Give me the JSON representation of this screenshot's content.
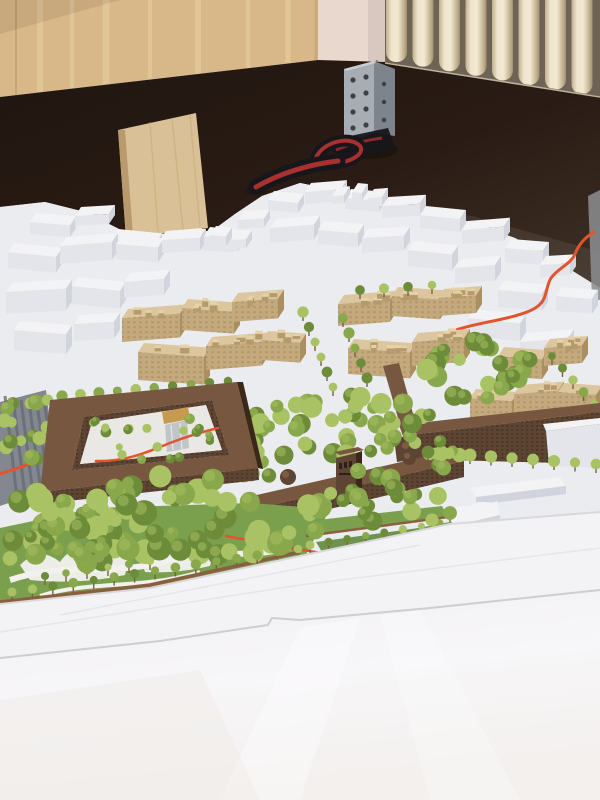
{
  "scene": {
    "type": "photograph",
    "description": "Photograph of a large architectural scale model of a city district, viewed from above. White context buildings surround a development site with dark brown brick buildings (a courtyard block, a long building with a central tower and domed pavilions, and an L-shaped perimeter block), light wood massing blocks for proposed buildings, many green model trees, a park with lawns and white paths, an orange route line, and a glossy white river plane in the foreground. Behind the model: a light wood cabinet, a pink plaster wall, a cream cast-iron radiator, a dark brown backdrop panel with a metal corner bracket, a leaning plywood board and a black strap with a red stripe."
  },
  "objects": [
    {
      "name": "wood-cabinet",
      "description": "light birch wood cabinet panel, top left"
    },
    {
      "name": "plaster-wall",
      "description": "pink plaster wall strip behind the model"
    },
    {
      "name": "radiator",
      "description": "cream cast-iron column radiator, top right"
    },
    {
      "name": "backdrop-panel",
      "description": "dark brown backdrop panel around the model"
    },
    {
      "name": "corner-bracket",
      "description": "perforated metal angle bracket at panel corner"
    },
    {
      "name": "plywood-board",
      "description": "plywood board leaning against the panel"
    },
    {
      "name": "fabric-strap",
      "description": "black strap with red stripe lying on the model"
    },
    {
      "name": "context-model",
      "description": "white massing model of surrounding city blocks"
    },
    {
      "name": "route-line",
      "description": "orange route line winding through the model"
    },
    {
      "name": "wood-massing-blocks",
      "description": "light wood blocks of proposed development with rooftop volumes"
    },
    {
      "name": "courtyard-building",
      "description": "dark brown courtyard block with gold-roofed hall and glass pavilion inside"
    },
    {
      "name": "tower-building",
      "description": "long brown building with central tower and two domed pavilions"
    },
    {
      "name": "perimeter-building",
      "description": "L-shaped brown perimeter building with street trees"
    },
    {
      "name": "model-trees",
      "description": "green foam model trees in park and along streets"
    },
    {
      "name": "park-lawn",
      "description": "green lawns with curving white paths and wooden edge walls"
    },
    {
      "name": "embankment",
      "description": "white embankment promenade"
    },
    {
      "name": "river-surface",
      "description": "glossy white river plane in the foreground"
    },
    {
      "name": "railway-strip",
      "description": "grey striped road/rail strip at left edge"
    }
  ],
  "colors": {
    "wood_cabinet": "#d8b888",
    "wood_cabinet_light": "#e9d3a7",
    "wood_cabinet_shadow": "#bd9c6f",
    "wall_plaster": "#e9d8ce",
    "radiator_gap": "#6e6354",
    "radiator_cream": "#efe4cc",
    "radiator_shadow": "#b3a489",
    "panel_edge_light": "#cfc3ac",
    "bracket_metal": "#a8adb3",
    "bracket_metal_dark": "#7e848b",
    "bracket_hole": "#3c4147",
    "plywood": "#d9c096",
    "plywood_edge": "#b89a6e",
    "strap_black": "#17161a",
    "strap_red": "#a8302e",
    "model_white": "#f3f3f6",
    "model_face_mid": "#e4e5ea",
    "model_face_shadow": "#d2d4dd",
    "model_base": "#ebecf0",
    "model_edge_gray": "#8d8e92",
    "railway_gray": "#83878f",
    "railway_stripe": "#656a73",
    "route_red": "#e2542f",
    "wood_block_top": "#dcc69e",
    "wood_block_side": "#c3a97c",
    "wood_block_shadow": "#ab8f60",
    "brick_brown": "#5e4433",
    "brick_brown_light": "#77573f",
    "brick_brown_dark": "#3a291b",
    "gold_roof": "#c69b4f",
    "glass_gray": "#b9bec2",
    "tree_green": "#89a74b",
    "tree_green_light": "#a9c263",
    "tree_green_dark": "#6d8c3a",
    "lawn_green": "#7aa04e",
    "lawn_dark": "#5f8a3c",
    "fence_brown": "#8a5f3e",
    "path_white": "#f2f1ee",
    "embankment_white": "#f3f2f4",
    "embankment_edge": "#d9d8dc",
    "river_white": "#f6f5f7"
  }
}
